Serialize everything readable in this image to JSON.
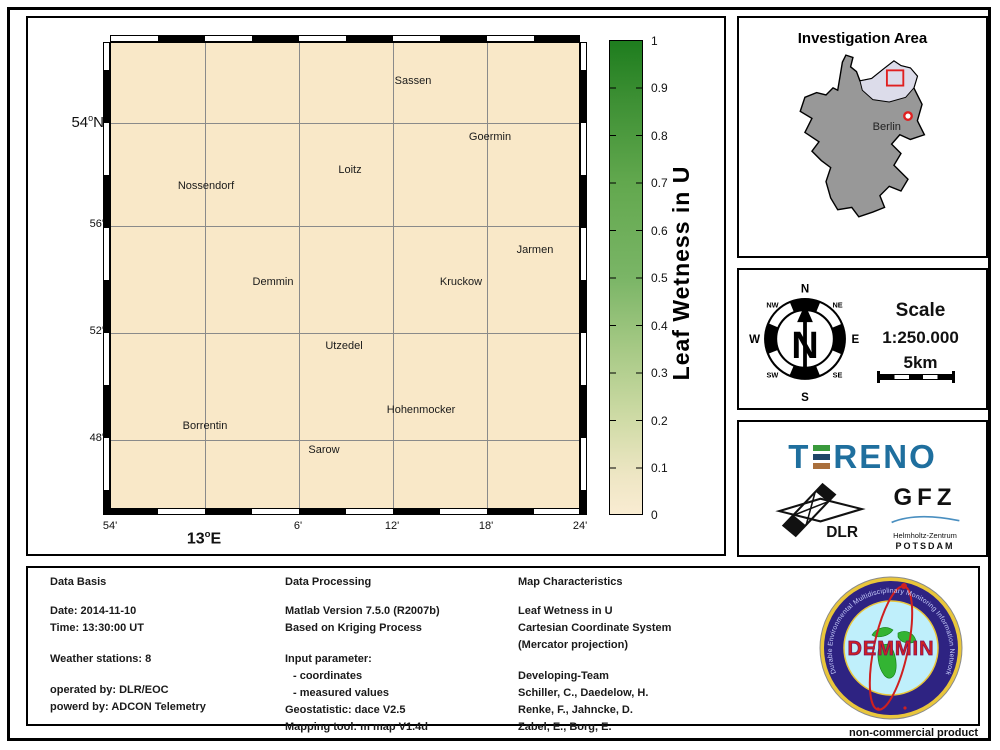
{
  "map": {
    "places": [
      "Sassen",
      "Goermin",
      "Loitz",
      "Nossendorf",
      "Jarmen",
      "Demmin",
      "Kruckow",
      "Utzedel",
      "Hohenmocker",
      "Borrentin",
      "Sarow"
    ],
    "x_ticks": [
      "54'",
      "6'",
      "12'",
      "18'",
      "24'"
    ],
    "y_ticks": [
      "56'",
      "52'",
      "48'"
    ],
    "y_main": {
      "num": "54",
      "deg": "o",
      "dir": "N"
    },
    "x_main": {
      "num": "13",
      "deg": "o",
      "dir": "E"
    },
    "fill_color": "#f9e8c8"
  },
  "colorbar": {
    "title": "Leaf Wetness in U",
    "ticks": [
      "1",
      "0.9",
      "0.8",
      "0.7",
      "0.6",
      "0.5",
      "0.4",
      "0.3",
      "0.2",
      "0.1",
      "0"
    ],
    "max_color": "#1e7d1e",
    "min_color": "#f9ecd2"
  },
  "investigation": {
    "title": "Investigation Area",
    "berlin": "Berlin",
    "highlight_color": "#dcdcea",
    "marker_color": "#e02020"
  },
  "compass": {
    "n": "N",
    "ne": "NE",
    "e": "E",
    "se": "SE",
    "s": "S",
    "sw": "SW",
    "w": "W",
    "nw": "NW",
    "needle": "N"
  },
  "scale": {
    "label": "Scale",
    "ratio": "1:250.000",
    "distance": "5km"
  },
  "logos": {
    "tereno_t": "T",
    "tereno_rest": "RENO",
    "tereno_color": "#1f6f9e",
    "ebar_colors": [
      "#3a9a3c",
      "#1f4567",
      "#aa6f3c"
    ],
    "dlr": "DLR",
    "gfz": "GFZ",
    "gfz_line1": "Helmholtz-Zentrum",
    "gfz_line2": "POTSDAM"
  },
  "demmin_logo": {
    "ring_text": "Durable Environmental Multidisciplinary Monitoring Information Network",
    "title": "DEMMIN"
  },
  "info_panel": {
    "col1": {
      "header": "Data Basis",
      "g1": [
        "Date: 2014-11-10",
        "Time: 13:30:00 UT"
      ],
      "g2": [
        "Weather stations: 8"
      ],
      "g3": [
        "operated by: DLR/EOC",
        "powerd by: ADCON Telemetry"
      ]
    },
    "col2": {
      "header": "Data Processing",
      "g1": [
        "Matlab Version 7.5.0 (R2007b)",
        "Based on Kriging Process"
      ],
      "g2": [
        "Input parameter:",
        "- coordinates",
        "- measured values",
        "Geostatistic: dace V2.5",
        "Mapping tool: m map V1.4d"
      ]
    },
    "col3": {
      "header": "Map Characteristics",
      "g1": [
        "Leaf Wetness in U",
        "Cartesian Coordinate System",
        "(Mercator projection)"
      ],
      "g2": [
        "Developing-Team",
        "Schiller, C., Daedelow, H.",
        "Renke, F., Jahncke, D.",
        "Zabel, E., Borg, E."
      ]
    }
  },
  "footer": {
    "note": "non-commercial product"
  }
}
